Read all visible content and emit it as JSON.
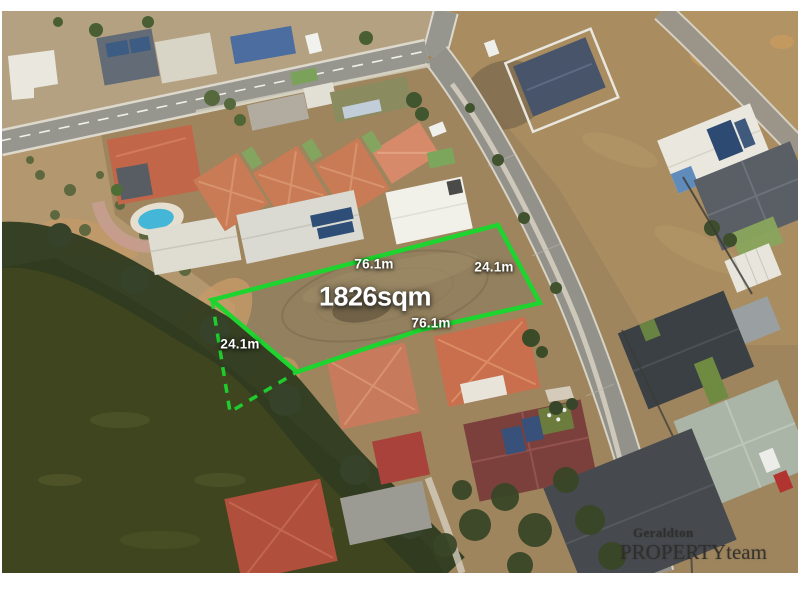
{
  "annotations": {
    "area": "1826sqm",
    "top_length": "76.1m",
    "bottom_length": "76.1m",
    "right_width": "24.1m",
    "left_width": "24.1m"
  },
  "logo": {
    "brand_top": "Geraldton",
    "brand_caps": "PROPERTY",
    "brand_lower": "team"
  },
  "colors": {
    "boundary_green": "#1ed42f",
    "label_text": "#ffffff",
    "logo_text": "#2e2d2a",
    "water": "#3f451f",
    "vacant_dirt": "#93805e",
    "road_gray": "#92918a"
  }
}
